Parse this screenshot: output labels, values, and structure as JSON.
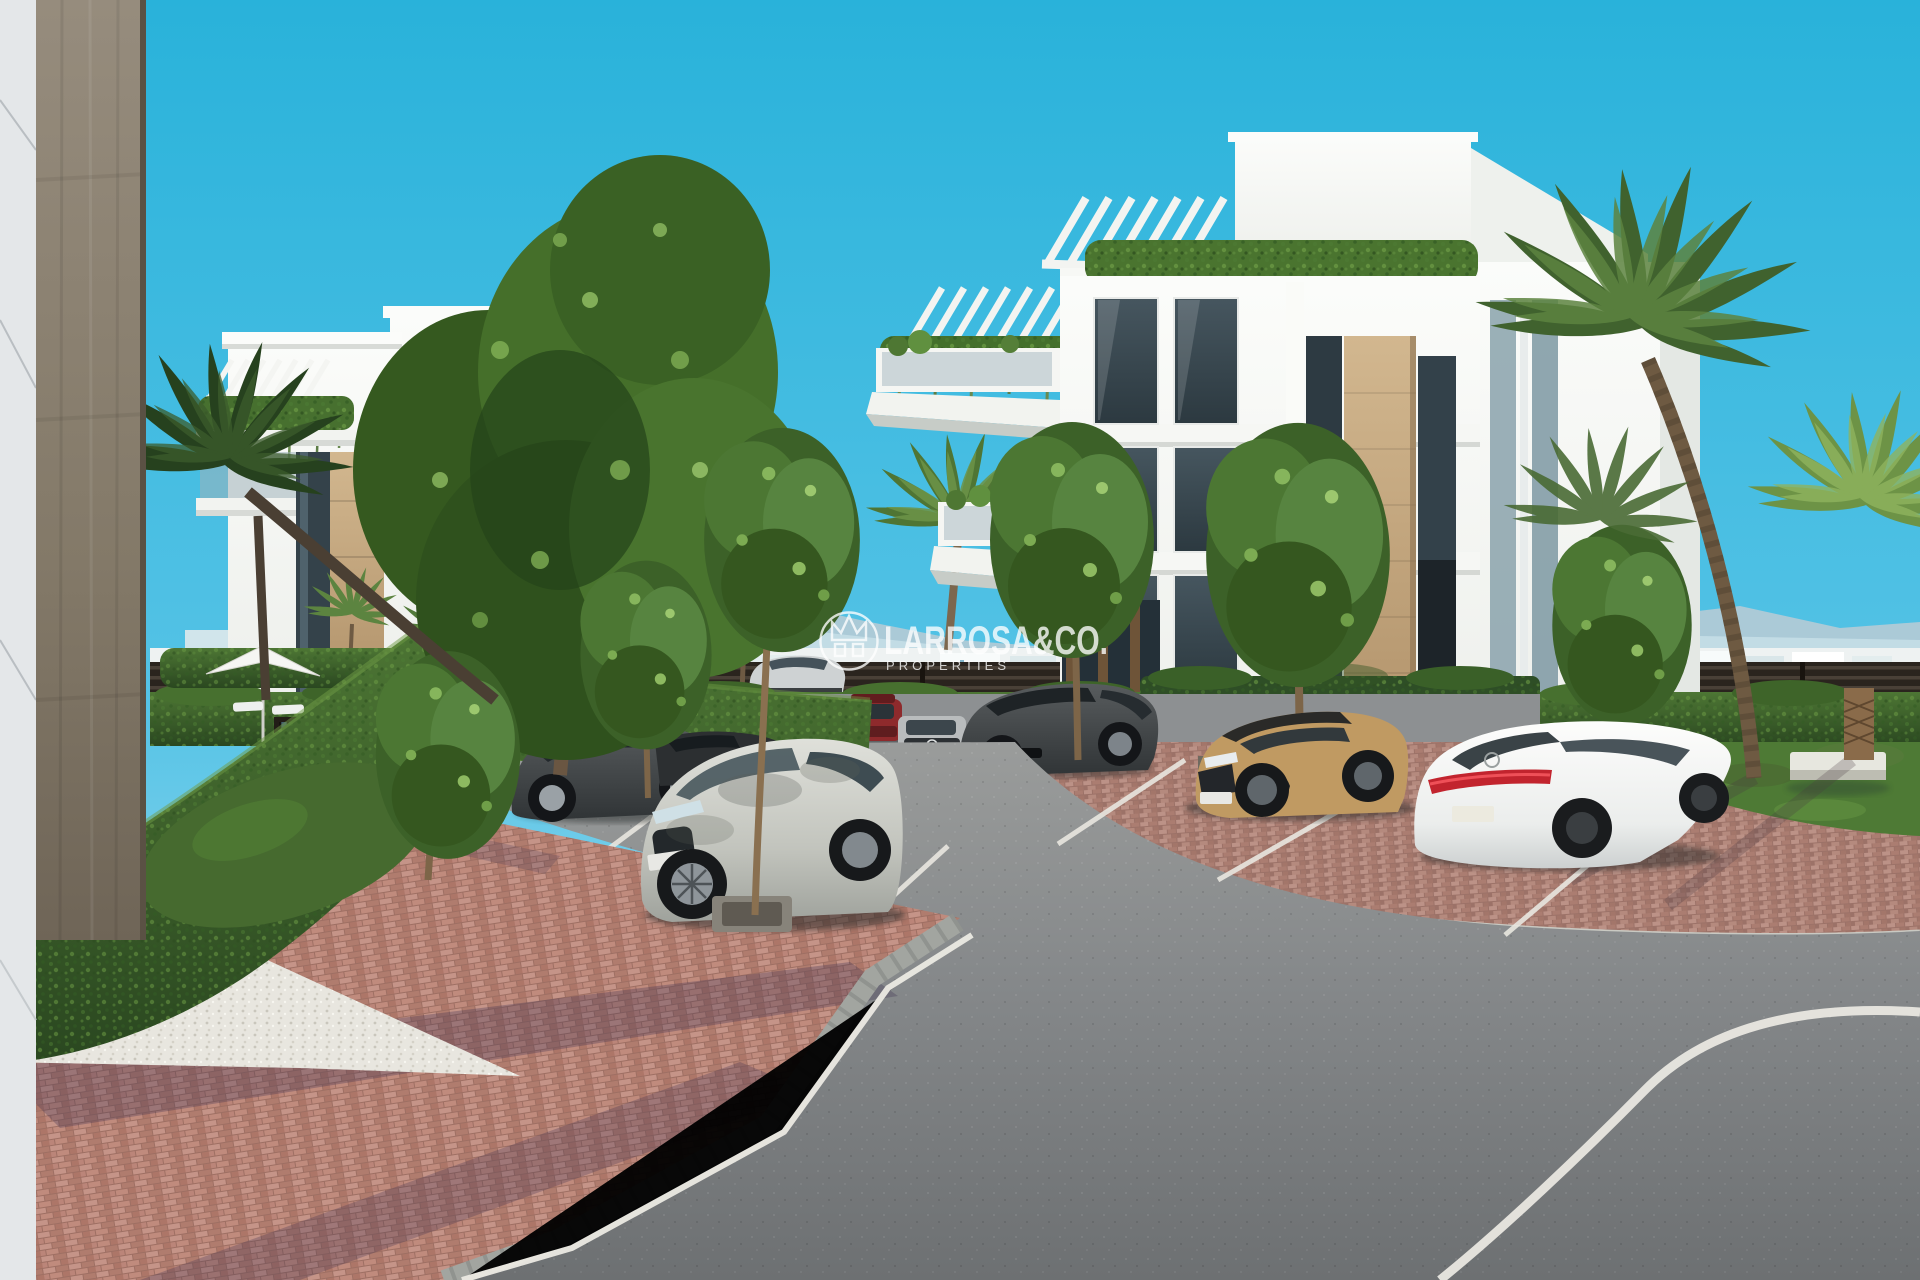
{
  "watermark": {
    "brand": "LARROSA&CO.",
    "tagline": "PROPERTIES",
    "logo_icon": "crown-logo-icon",
    "color": "#ffffff",
    "opacity": 0.78
  },
  "scene": {
    "type": "3d-architectural-render",
    "subject": "Modern white apartment buildings with parking area, palm trees, clipped hedges and a curving asphalt road under a clear cyan sky",
    "palette": {
      "sky_top": "#29b2da",
      "sky_horizon": "#cdeef7",
      "building_white": "#f7f8f5",
      "building_tan_accent": "#c4a77c",
      "window_glass": "#35444d",
      "hedge_green": "#3a6128",
      "brick_paving": "#bb8579",
      "asphalt": "#7c7f80",
      "gravel": "#e8e6df",
      "road_marking": "#eceae3",
      "fence_dark": "#2a241e"
    },
    "buildings": [
      {
        "id": "left-building",
        "style": "white modern block, rooftop pergola, hanging balcony plants, tan stone band, dark glazing"
      },
      {
        "id": "right-building",
        "style": "white modern block, stepped penthouse with pergolas, cascading balcony plants, tan stone band, dark glazing"
      },
      {
        "id": "foreground-building-edge",
        "style": "close-up corner with light cladding panel and brown stone column"
      }
    ],
    "vehicles": [
      {
        "id": "foreground-silver-suv",
        "color": "#c9cac3",
        "view": "front-three-quarter, dappled tree shadow"
      },
      {
        "id": "dark-gray-suv",
        "color": "#4a4e50",
        "view": "side, behind street tree"
      },
      {
        "id": "black-sedan",
        "color": "#2c2f31",
        "view": "side, partially hidden"
      },
      {
        "id": "teal-hatchback",
        "color": "#5d809a",
        "view": "partial, behind tree"
      },
      {
        "id": "driving-silver-car",
        "color": "#ced2d3",
        "view": "side, on far road"
      },
      {
        "id": "red-suv",
        "color": "#8e2a2c",
        "view": "front, far parking row"
      },
      {
        "id": "silver-mercedes-suv",
        "color": "#b9bcbd",
        "view": "front, far parking row"
      },
      {
        "id": "dark-suv-santa-fe",
        "color": "#3f4245",
        "view": "front-three-quarter"
      },
      {
        "id": "second-red-suv",
        "color": "#7e2628",
        "view": "front, behind hedge"
      },
      {
        "id": "second-silver-suv",
        "color": "#b5b8b9",
        "view": "front, behind hedge"
      },
      {
        "id": "second-dark-suv",
        "color": "#3a3e41",
        "view": "front, behind hedge"
      },
      {
        "id": "tan-toyota-suv",
        "color": "#c09a62",
        "view": "front-three-quarter, black roof"
      },
      {
        "id": "white-mercedes-sedan",
        "color": "#f4f4f2",
        "view": "rear-three-quarter, full-width red taillight bar"
      }
    ],
    "ground": {
      "road": "gray asphalt with white edge lines and parking bay lines",
      "paving": "red clay brick with tree shadows",
      "curb": "gray cobblestone curb band",
      "accents": "white gravel border, lawn patches"
    },
    "vegetation": [
      "boxwood hedges",
      "deciduous street trees",
      "fan palms",
      "hanging balcony plants",
      "lawn",
      "large center tree cluster"
    ],
    "street_furniture": [
      "white parasol",
      "sun loungers",
      "dark pool railing",
      "white concrete bench"
    ]
  }
}
